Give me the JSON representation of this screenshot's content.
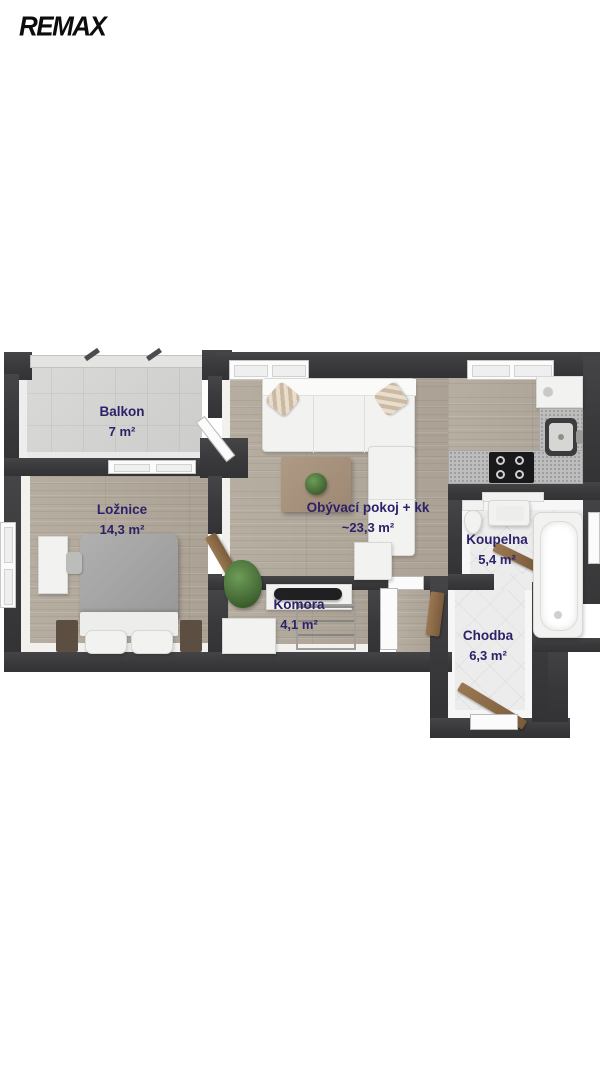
{
  "logo": {
    "brand": "REMAX"
  },
  "plan": {
    "rooms": {
      "balkon": {
        "name": "Balkon",
        "area": "7 m²"
      },
      "loznice": {
        "name": "Ložnice",
        "area": "14,3 m²"
      },
      "obyvaci_pokoj": {
        "name": "Obývací pokoj + kk",
        "area": "~23,3 m²"
      },
      "komora": {
        "name": "Komora",
        "area": "4,1 m²"
      },
      "koupelna": {
        "name": "Koupelna",
        "area": "5,4 m²"
      },
      "chodba": {
        "name": "Chodba",
        "area": "6,3 m²"
      }
    },
    "colors": {
      "wall": "#3a3a3c",
      "wood_floor": "#b3aa9e",
      "balcony_tile": "#d5d5d3",
      "bath_tile": "#ececec",
      "label_text": "#2b2268",
      "door_wood": "#8a6a48",
      "furniture_white": "#f2f2f1",
      "background": "#ffffff"
    }
  }
}
